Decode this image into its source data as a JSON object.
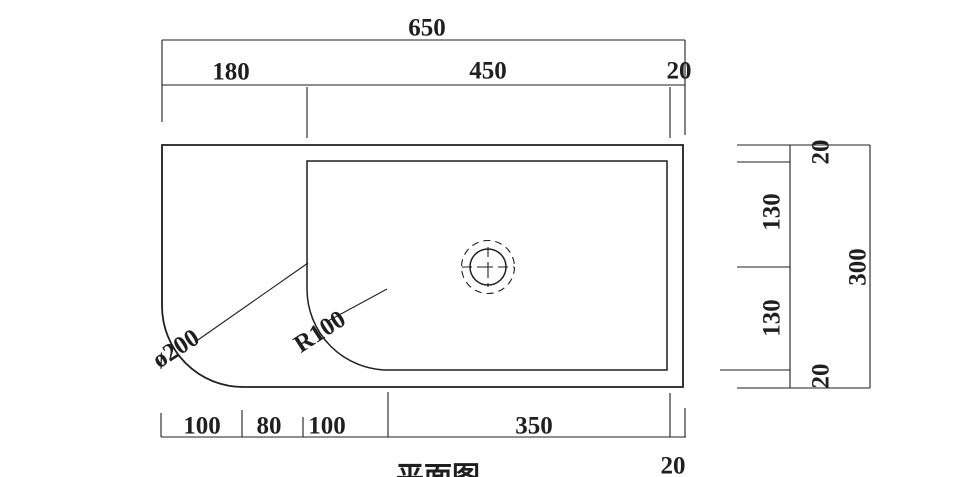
{
  "colors": {
    "line": "#1f1f1f",
    "background": "#ffffff"
  },
  "drawing": {
    "view_title_partial": "平面图",
    "top_dims": {
      "total_width": "650",
      "segments": [
        "180",
        "450",
        "20"
      ]
    },
    "bottom_dims": {
      "segments": [
        "100",
        "80",
        "100",
        "350"
      ],
      "right_gap": "20"
    },
    "side_dims": {
      "total_height": "300",
      "segments_top_to_bottom": [
        "20",
        "130",
        "130",
        "20"
      ]
    },
    "annotations": {
      "corner_diameter": "ø200",
      "basin_corner_radius": "R100"
    }
  }
}
